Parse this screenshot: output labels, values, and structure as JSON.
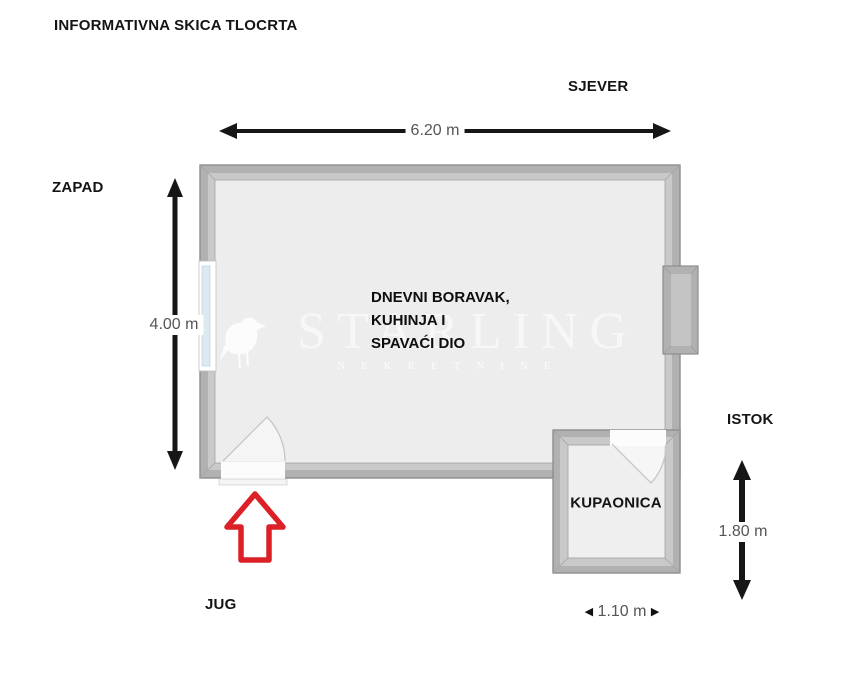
{
  "title": "INFORMATIVNA SKICA TLOCRTA",
  "compass": {
    "north": "SJEVER",
    "west": "ZAPAD",
    "east": "ISTOK",
    "south": "JUG"
  },
  "rooms": {
    "main": {
      "label_lines": [
        "DNEVNI BORAVAK,",
        "KUHINJA I",
        "SPAVAĆI DIO"
      ]
    },
    "bathroom": {
      "label": "KUPAONICA"
    }
  },
  "dimensions": {
    "top_width": "6.20 m",
    "left_height": "4.00 m",
    "right_height": "1.80 m",
    "bottom_width": "1.10 m",
    "triangle_left_glyph": "◀",
    "triangle_right_glyph": "▶"
  },
  "watermark": {
    "brand": "STARLING",
    "tagline": "NEKRETNINE",
    "logo": "starling-bird-icon"
  },
  "colors": {
    "wall_gray": "#b1b1b1",
    "wall_bevel": "#c9c9c9",
    "floor_gray": "#ededed",
    "window_glass": "#dce9f1",
    "entrance_arrow_red": "#dc2027",
    "dimension_text": "#565656",
    "label_black": "#141414"
  }
}
